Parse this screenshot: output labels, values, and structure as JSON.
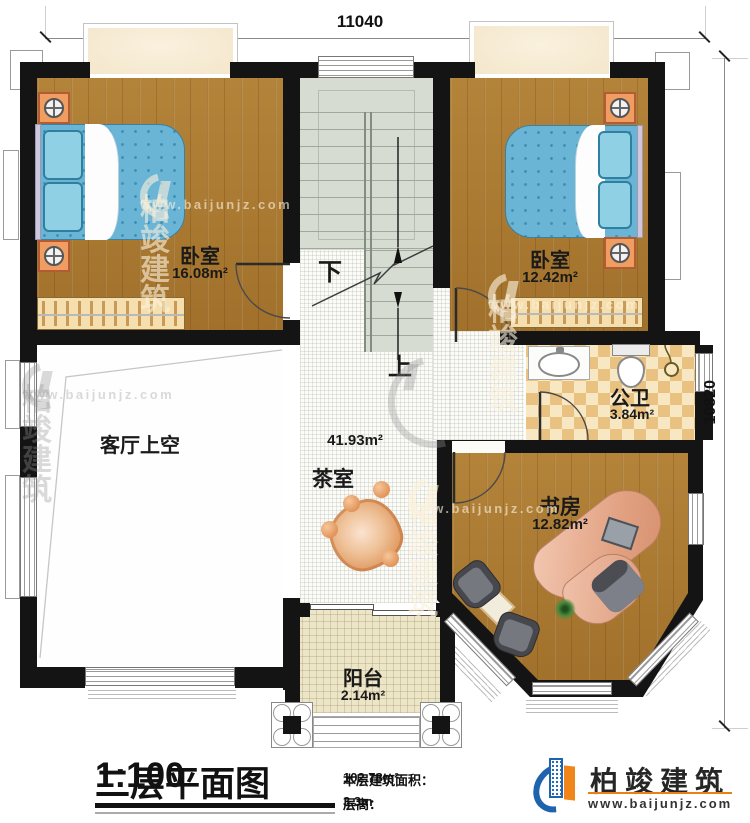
{
  "dimensions": {
    "width_top": "11040",
    "height_right": "10820"
  },
  "stairs": {
    "down_label": "下",
    "up_label": "上"
  },
  "rooms": {
    "bedroom_left": {
      "name": "卧室",
      "area": "16.08m²"
    },
    "bedroom_right": {
      "name": "卧室",
      "area": "12.42m²"
    },
    "bathroom": {
      "name": "公卫",
      "area": "3.84m²"
    },
    "living_void": {
      "name": "客厅上空"
    },
    "tea_room": {
      "name": "茶室",
      "area": "41.93m²"
    },
    "study": {
      "name": "书房",
      "area": "12.82m²"
    },
    "balcony": {
      "name": "阳台",
      "area": "2.14m²"
    }
  },
  "title_block": {
    "title": "二层平面图",
    "scale": "1:100",
    "area_label": "本层建筑面积：",
    "area_value": "102.78m²",
    "height_label": "层高：",
    "height_value": "3.3m"
  },
  "branding": {
    "company": "柏竣建筑",
    "website": "www.baijunjz.com"
  },
  "watermark": {
    "company": "柏竣建筑",
    "website": "www.baijunjz.com"
  },
  "colors": {
    "wall": "#141414",
    "wood_floor": "#ab7a31",
    "bed_blue": "#6ab4d6",
    "stair_gray": "#d7dcd3",
    "bath_tile_light": "#f7e7c3",
    "bath_tile_dark": "#e9c180",
    "balcony_floor": "#ece5c6",
    "brand_blue": "#1e63ad",
    "brand_orange": "#f08519"
  }
}
